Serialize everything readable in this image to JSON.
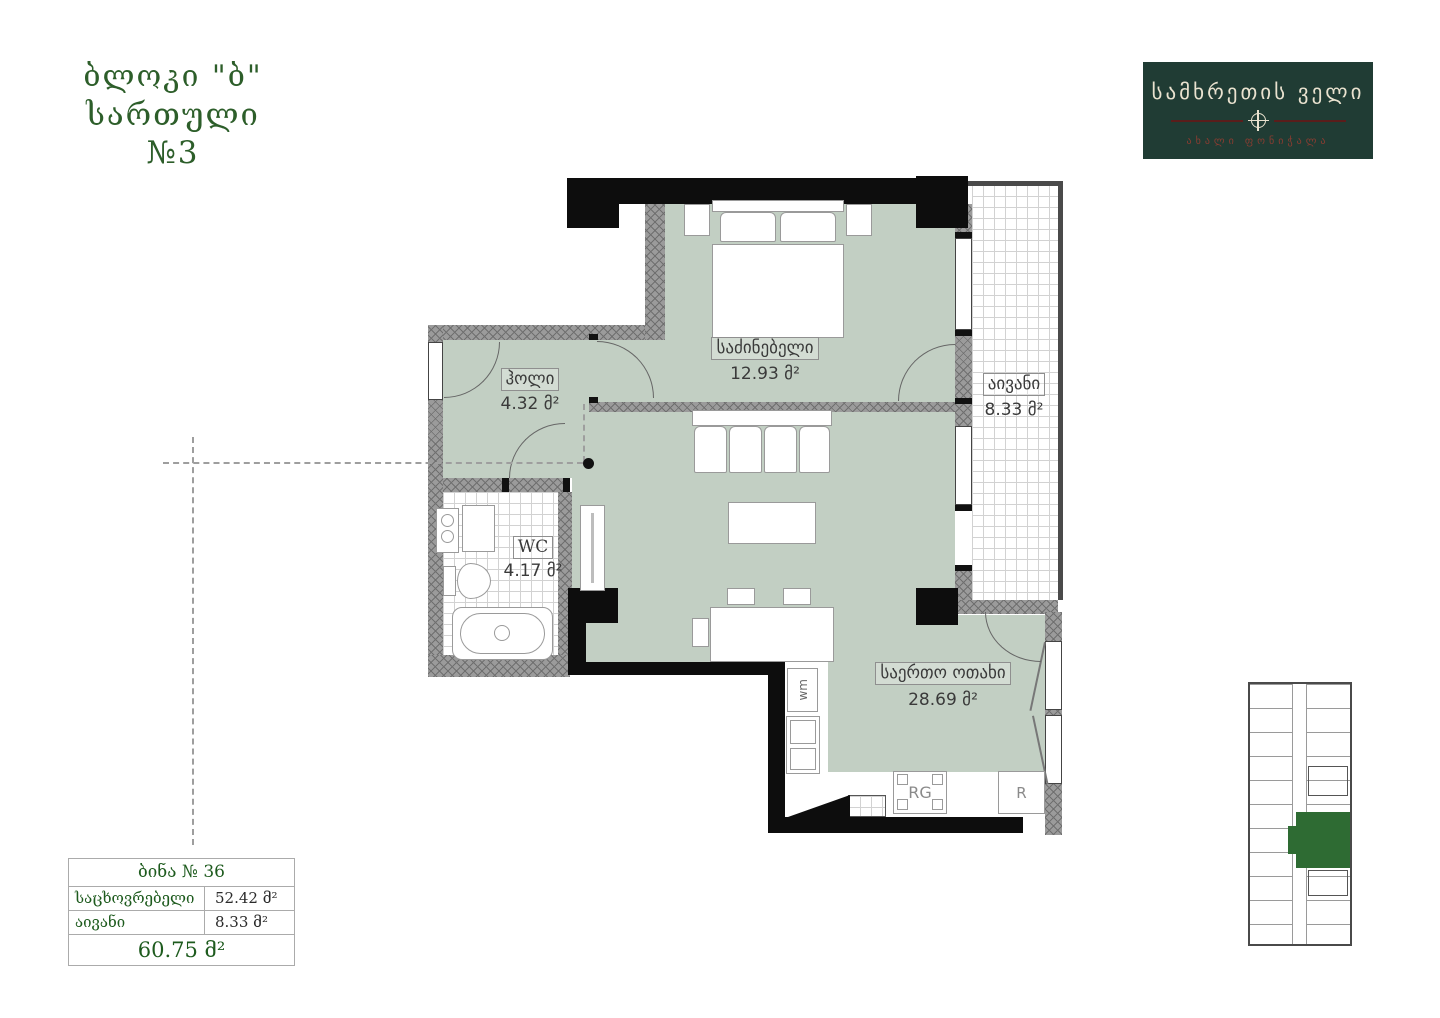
{
  "title": {
    "line1": "ბლოკი \"ბ\"",
    "line2": "სართული №3"
  },
  "logo": {
    "name": "სამხრეთის ველი",
    "subtitle": "ახალი ფონიჭალა",
    "bg_color": "#203c34",
    "accent_color": "#5a1d1b",
    "text_color": "#e9e2cf"
  },
  "rooms": [
    {
      "id": "bedroom",
      "name": "საძინებელი",
      "area": "12.93 მ²"
    },
    {
      "id": "hall",
      "name": "ჰოლი",
      "area": "4.32 მ²"
    },
    {
      "id": "wc",
      "name": "WC",
      "area": "4.17 მ²"
    },
    {
      "id": "balcony",
      "name": "აივანი",
      "area": "8.33 მ²"
    },
    {
      "id": "living",
      "name": "საერთო ოთახი",
      "area": "28.69 მ²"
    }
  ],
  "appliances": {
    "washing_machine": "wm",
    "range": "RG",
    "refrigerator": "R"
  },
  "summary_table": {
    "header": "ბინა № 36",
    "rows": [
      {
        "label": "საცხოვრებელი",
        "value": "52.42 მ²"
      },
      {
        "label": "აივანი",
        "value": "8.33 მ²"
      }
    ],
    "total": "60.75 მ²"
  },
  "colors": {
    "room_fill": "#c2cfc3",
    "wall_black": "#0d0d0d",
    "wall_gray": "#9b9b9b",
    "title_green": "#2d5e2a",
    "table_green": "#1e5b1e",
    "unit_highlight_green": "#2e6b33"
  }
}
